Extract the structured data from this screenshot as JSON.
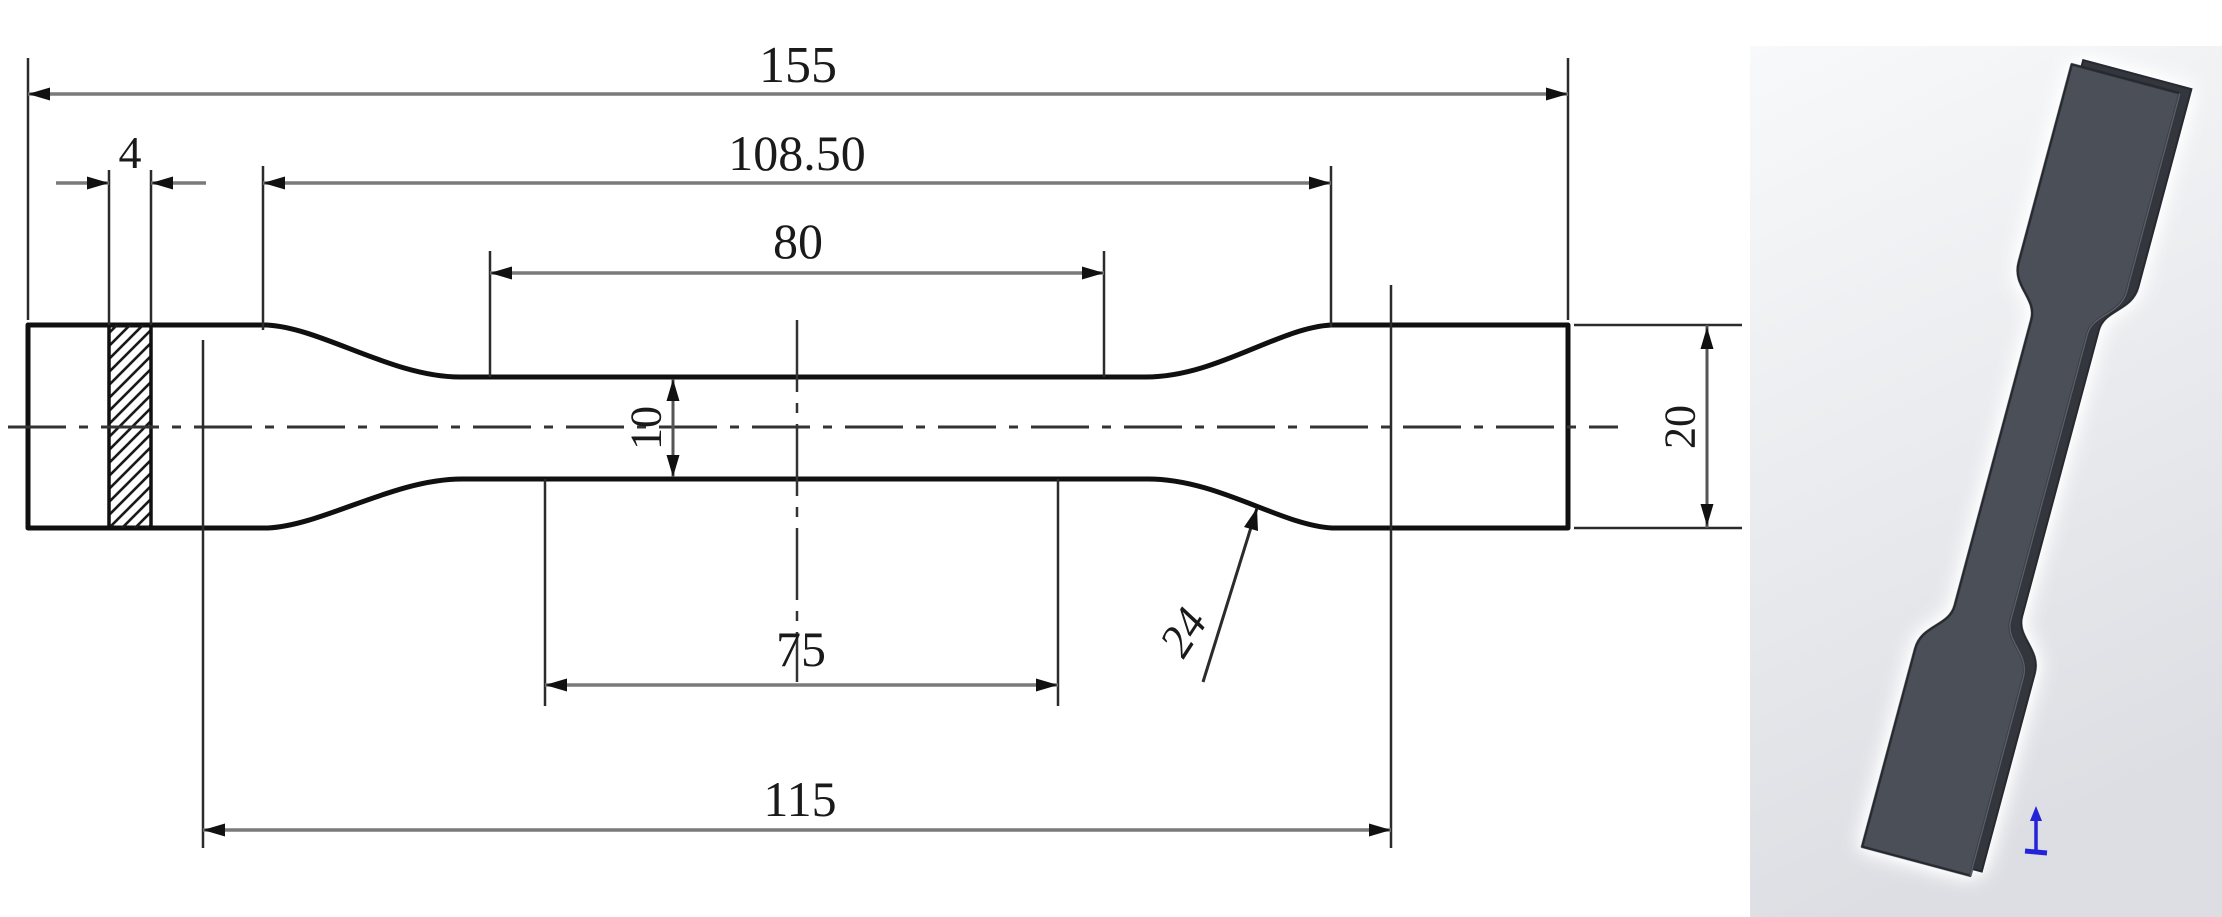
{
  "figure": {
    "left_view": "2d-dimensioned-drawing",
    "right_view": "3d-rendered-specimen"
  },
  "dims": {
    "total_length": "155",
    "shoulder_span": "108.50",
    "gauge_length": "80",
    "gauge_width": "10",
    "reduced_section_length": "75",
    "parallel_length": "115",
    "section_thickness": "4",
    "grip_width": "20",
    "fillet_radius": "24"
  },
  "colors": {
    "outline": "#101010",
    "extension_line": "#2b2b2b",
    "dimension_line": "#7a7a7a",
    "arrowhead": "#111111",
    "centerline": "#333333",
    "hatch": "#1a1a1a",
    "text": "#1a1a1a",
    "panel_gradient_top": "#f8f9fa",
    "panel_gradient_bottom": "#dcdee3",
    "specimen_body": "#4b4f57",
    "specimen_side": "#33363d",
    "specimen_edge": "#262930",
    "origin_marker_blue": "#2323d8"
  }
}
